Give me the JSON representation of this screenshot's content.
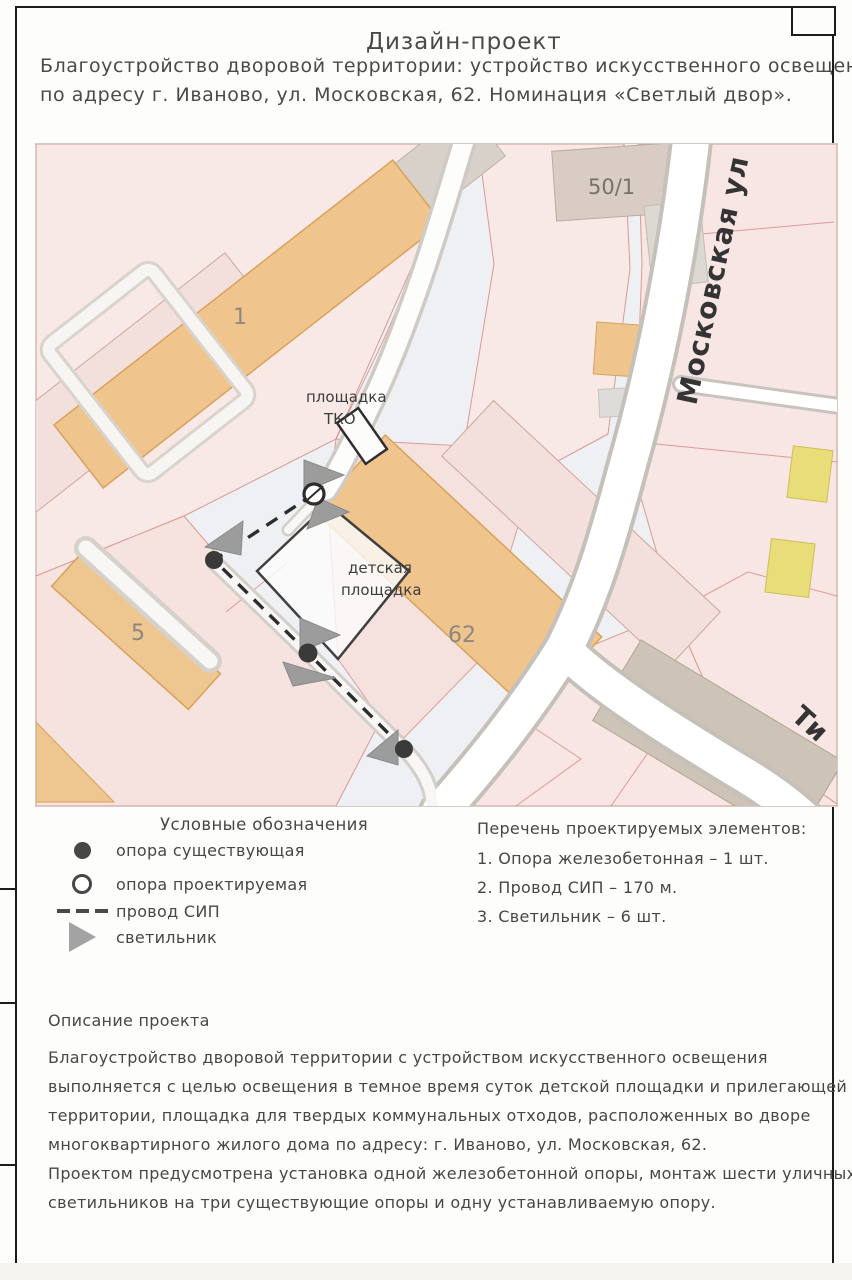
{
  "header": {
    "title": "Дизайн-проект",
    "subtitle_line1": "Благоустройство дворовой территории: устройство искусственного освещения",
    "subtitle_line2": "по адресу г. Иваново, ул. Московская, 62. Номинация «Светлый двор»."
  },
  "map": {
    "labels": {
      "house_1": "1",
      "house_5": "5",
      "house_62": "62",
      "house_50_1": "50/1",
      "street_moskovskaya": "Московская ул",
      "street_ti": "Ти",
      "tko_line1": "площадка",
      "tko_line2": "ТКО",
      "playground_line1": "детская",
      "playground_line2": "площадка"
    }
  },
  "legend": {
    "title": "Условные обозначения",
    "items": [
      {
        "symbol": "filled-circle",
        "label": "опора существующая"
      },
      {
        "symbol": "open-circle",
        "label": "опора проектируемая"
      },
      {
        "symbol": "dashed-line",
        "label": "провод СИП"
      },
      {
        "symbol": "triangle",
        "label": "светильник"
      }
    ]
  },
  "elements_list": {
    "title": "Перечень проектируемых элементов:",
    "items": [
      "1. Опора железобетонная – 1 шт.",
      "2. Провод СИП – 170 м.",
      "3. Светильник – 6 шт."
    ]
  },
  "description": {
    "title": "Описание проекта",
    "lines": [
      "Благоустройство дворовой территории с устройством искусственного освещения",
      "выполняется с целью освещения в темное время суток детской площадки и прилегающей",
      "территории, площадка для твердых коммунальных отходов, расположенных во дворе",
      "многоквартирного жилого дома по адресу: г. Иваново, ул. Московская, 62.",
      "Проектом предусмотрена установка одной железобетонной опоры, монтаж шести уличных",
      "светильников на три существующие опоры и одну устанавливаемую опору."
    ]
  },
  "colors": {
    "building_orange": "#efc48d",
    "building_gray": "#d8d1c9",
    "building_yellow": "#e9dd7a",
    "parcel_pink": "#f7e6e3",
    "road_white": "#ffffff",
    "overlay_dark": "#2c2c2c",
    "lamp_gray": "#9c9c9c"
  }
}
